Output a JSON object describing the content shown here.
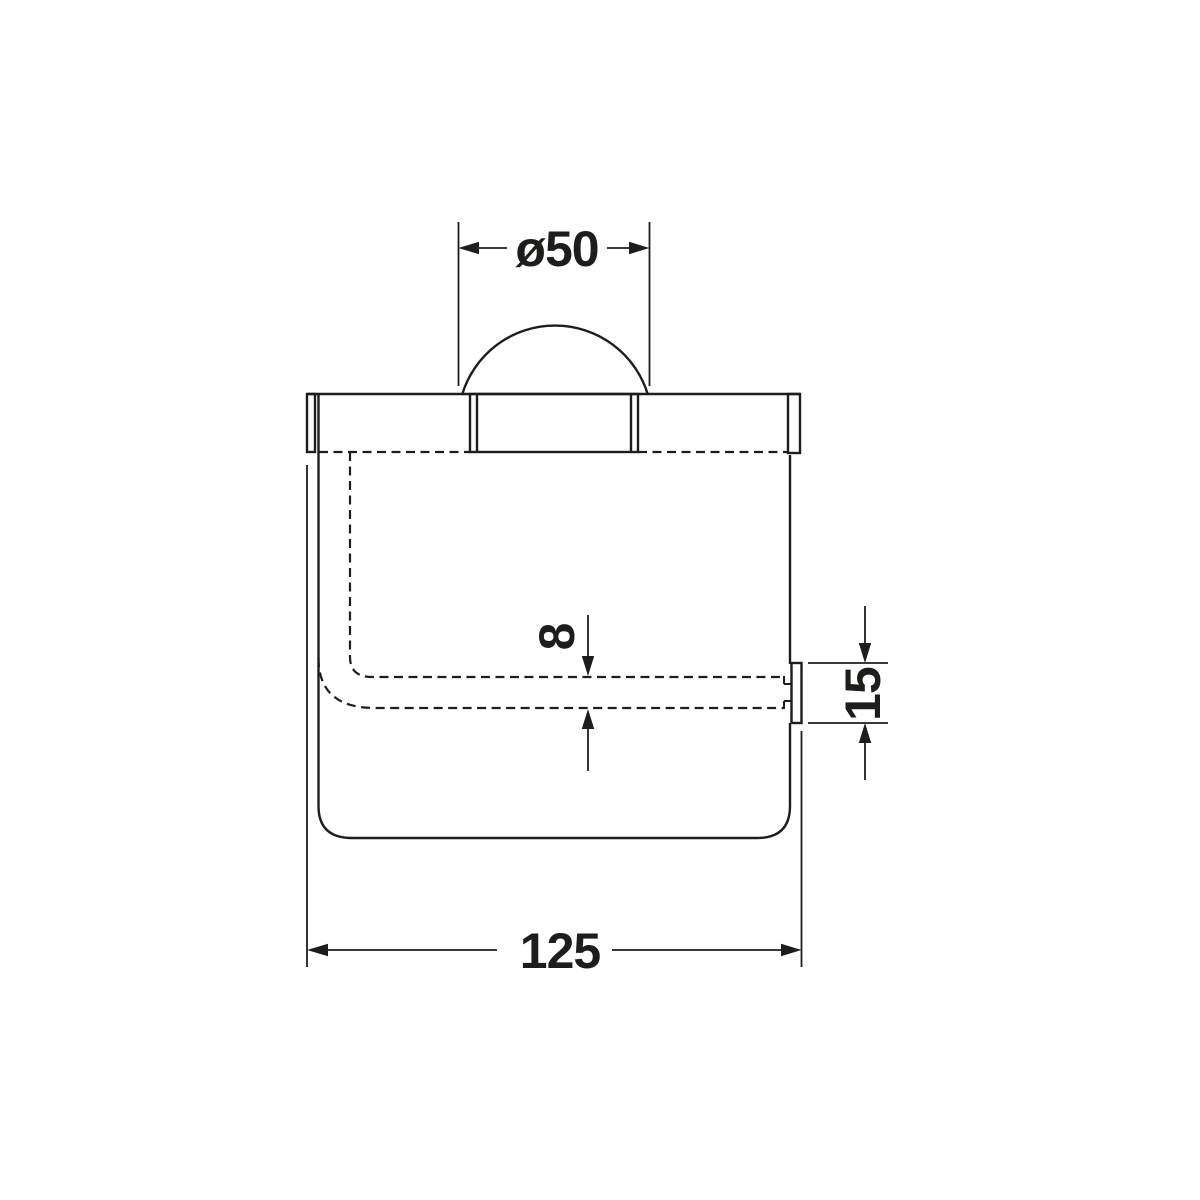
{
  "diagram": {
    "background_color": "#ffffff",
    "line_color": "#1d1d1b",
    "dimensions": {
      "spindle_diameter": {
        "label": "ø50",
        "value": 50
      },
      "roll_bar_thickness": {
        "label": "8",
        "value": 8
      },
      "pin_height": {
        "label": "15",
        "value": 15
      },
      "overall_width": {
        "label": "125",
        "value": 125
      }
    }
  }
}
